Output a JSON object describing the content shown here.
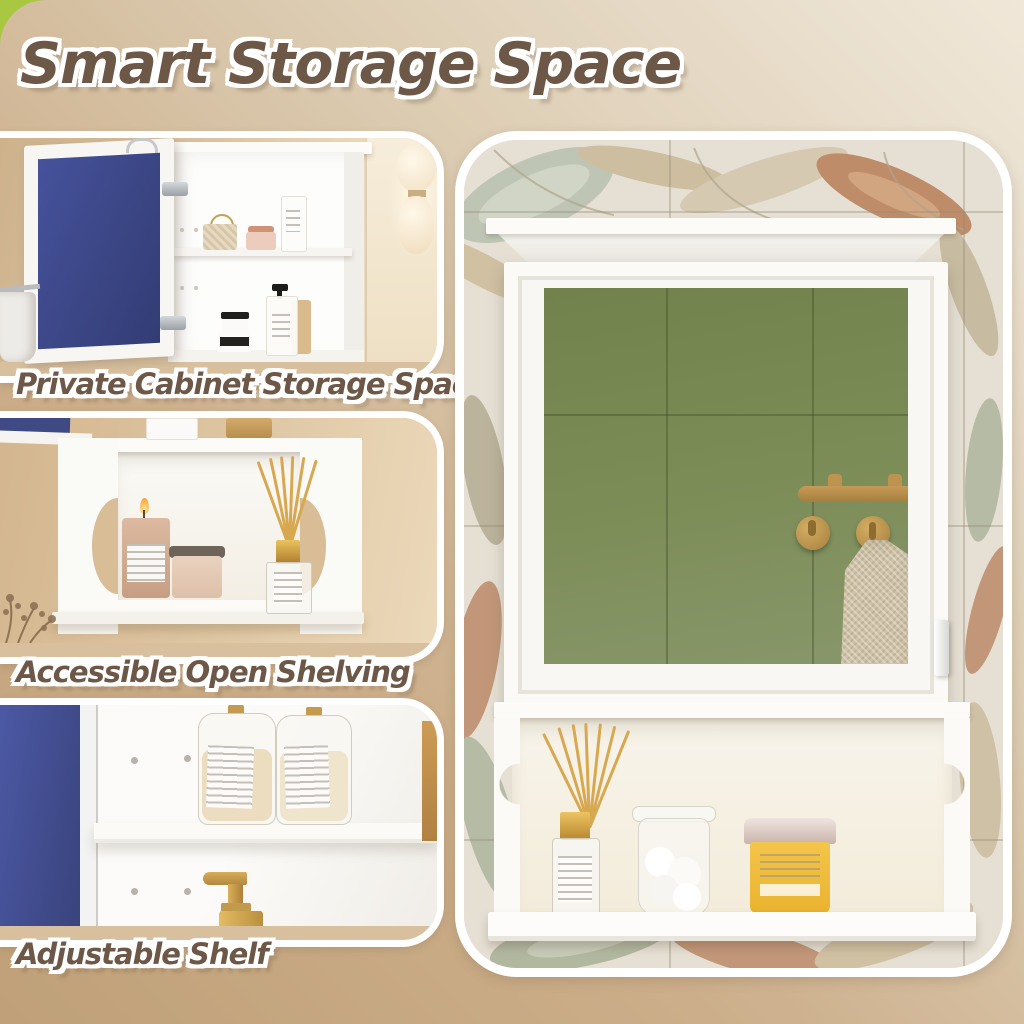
{
  "title": "Smart Storage Space",
  "features": [
    {
      "id": "private-cabinet",
      "caption": "Private Cabinet Storage Space"
    },
    {
      "id": "open-shelving",
      "caption": "Accessible Open Shelving"
    },
    {
      "id": "adjustable-shelf",
      "caption": "Adjustable Shelf"
    }
  ],
  "colors": {
    "text_brown": "#6d5747",
    "outline_white": "#ffffff",
    "corner_accent_green": "#a8c842",
    "background_tan": "#c9ab85",
    "background_cream": "#ece2d2",
    "mirror_tile_green": "#7a8a55",
    "brass_gold": "#b58a46",
    "cabinet_white": "#f8f7f3",
    "door_navy": "#46529b",
    "cream_jar_yellow": "#eeb93c"
  }
}
